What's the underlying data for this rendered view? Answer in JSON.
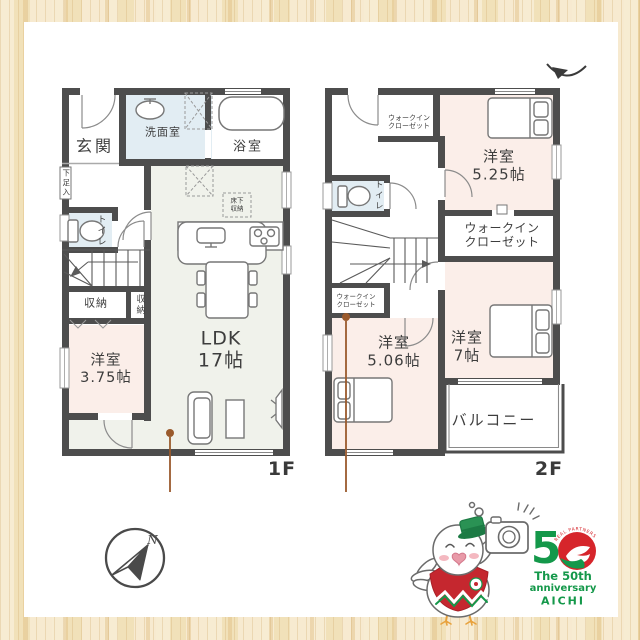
{
  "floor1": {
    "label": "1F",
    "rooms": {
      "entrance": "玄関",
      "washroom": "洗面室",
      "bathroom": "浴室",
      "shoe_storage": "下足入",
      "toilet": "トイレ",
      "underfloor_line1": "床下",
      "underfloor_line2": "収納",
      "storage_a": "収納",
      "storage_b": "収納",
      "bedroom_line1": "洋室",
      "bedroom_line2": "3.75帖",
      "ldk_line1": "LDK",
      "ldk_line2": "17帖"
    }
  },
  "floor2": {
    "label": "2F",
    "rooms": {
      "wic_north_line1": "ウォークイン",
      "wic_north_line2": "クローゼット",
      "bedroom_525_line1": "洋室",
      "bedroom_525_line2": "5.25帖",
      "toilet": "トイレ",
      "wic_west_line1": "ウォークイン",
      "wic_west_line2": "クローゼット",
      "wic_center_line1": "ウォークイン",
      "wic_center_line2": "クローゼット",
      "bedroom_506_line1": "洋室",
      "bedroom_506_line2": "5.06帖",
      "bedroom_7_line1": "洋室",
      "bedroom_7_line2": "7帖",
      "balcony": "バルコニー"
    }
  },
  "compass": {
    "north": "N"
  },
  "logo": {
    "digit": "5",
    "arc_text": "REAL PARTNERS",
    "line1": "The 50th",
    "line2": "anniversary",
    "line3": "AICHI"
  },
  "colors": {
    "wall": "#4d4d4d",
    "ldk_fill": "#f0f2eb",
    "bedroom_fill": "#fbeee9",
    "wet_fill": "#e2edf3",
    "annotation": "#9a5a2c",
    "logo_green": "#14984a",
    "logo_red": "#d6252b",
    "frame_wood": "#f5e7c8"
  }
}
